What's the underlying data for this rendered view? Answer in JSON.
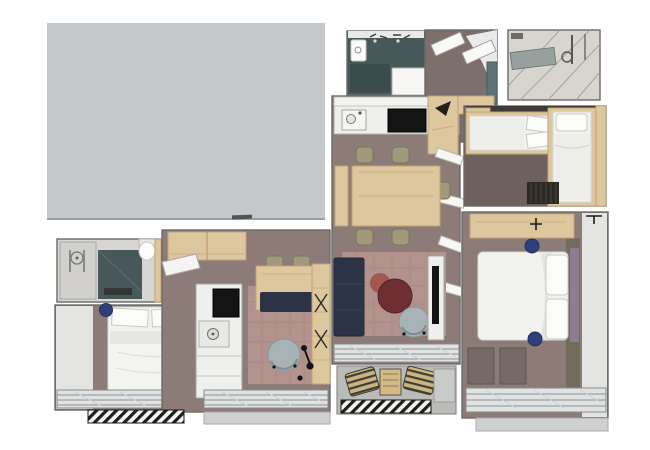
{
  "page": {
    "background": "#ffffff",
    "kind": "3D rendered floor plan, two apartment units, top-down view"
  },
  "colors": {
    "page_bg": "#ffffff",
    "cover_gray": "#c5c8cb",
    "cover_gray_edge": "#9b9ea2",
    "wall_light": "#e4e5e3",
    "floor_room": "#8d7b77",
    "floor_hall": "#7d6f6c",
    "floor_dark": "#6e615d",
    "rug_pink": "#b2928c",
    "wood": "#ddc79f",
    "wood_dark": "#c3a274",
    "white_furniture": "#efefed",
    "teal_floor": "#46585a",
    "teal_cabinet": "#5d7476",
    "sofa_navy": "#2c3347",
    "table_maroon": "#6e2e33",
    "table_red": "#a2584f",
    "chair_gray": "#a7b3b7",
    "chair_olive": "#9f987b",
    "pouf_navy": "#2f3f7c",
    "headboard_mauve": "#8e7d91",
    "bed_white": "#f2f2f0",
    "bed_shadow": "#d8d8d4",
    "glass": "#dfe3e3",
    "balcony_floor": "#babcb9",
    "sill_gray": "#cfd1d0",
    "cushion_tan": "#cdb380",
    "radiator_dark": "#2c2824"
  },
  "scene": {
    "cover_panel": {
      "label": "blank gray panel"
    },
    "unit_right": {
      "rooms": [
        "bathroom",
        "entry-hall",
        "shower-room",
        "kitchen-dining",
        "living-room",
        "balcony",
        "kids-bedroom",
        "master-bedroom"
      ],
      "furniture": [
        "kitchen counter with sink and cooktop",
        "dining table with five chairs",
        "navy sofa",
        "round maroon coffee table",
        "gray lounge chair",
        "tv unit",
        "two single beds",
        "radiator",
        "double bed with pillows",
        "desk",
        "navy poufs",
        "balcony benches with striped cushions"
      ]
    },
    "unit_left": {
      "rooms": [
        "bathroom",
        "bedroom",
        "kitchen",
        "living-area"
      ],
      "furniture": [
        "vanity",
        "shower",
        "toilet",
        "double bed with pillows",
        "navy pouf",
        "upper wood cabinets",
        "tall kitchen unit with oven and sink",
        "desk with bench and chairs",
        "wardrobe",
        "gray lounge chair",
        "floor lamp"
      ]
    }
  }
}
